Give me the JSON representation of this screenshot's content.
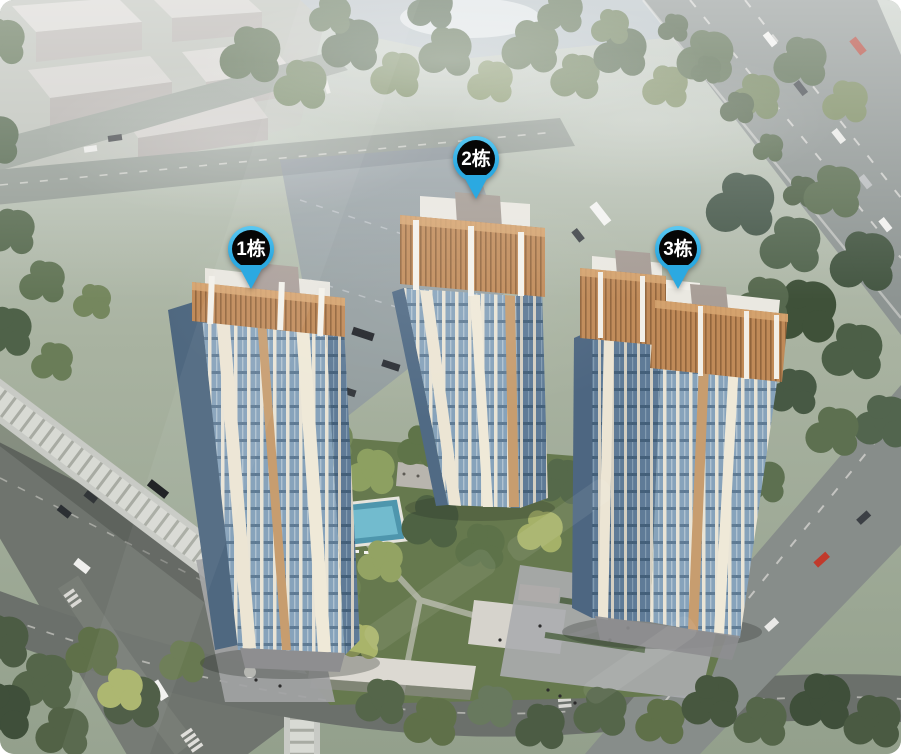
{
  "view": {
    "type": "building-selection-aerial-view",
    "building_count": 3
  },
  "markers": [
    {
      "id": "building-1",
      "label": "1栋",
      "x": 251,
      "y": 289
    },
    {
      "id": "building-2",
      "label": "2栋",
      "x": 476,
      "y": 199
    },
    {
      "id": "building-3",
      "label": "3栋",
      "x": 678,
      "y": 289
    }
  ],
  "marker_style": {
    "pin_color": "#2ba9e1",
    "pin_color_light": "#5bc8f2",
    "badge_color": "#060606",
    "text_color": "#ffffff"
  }
}
